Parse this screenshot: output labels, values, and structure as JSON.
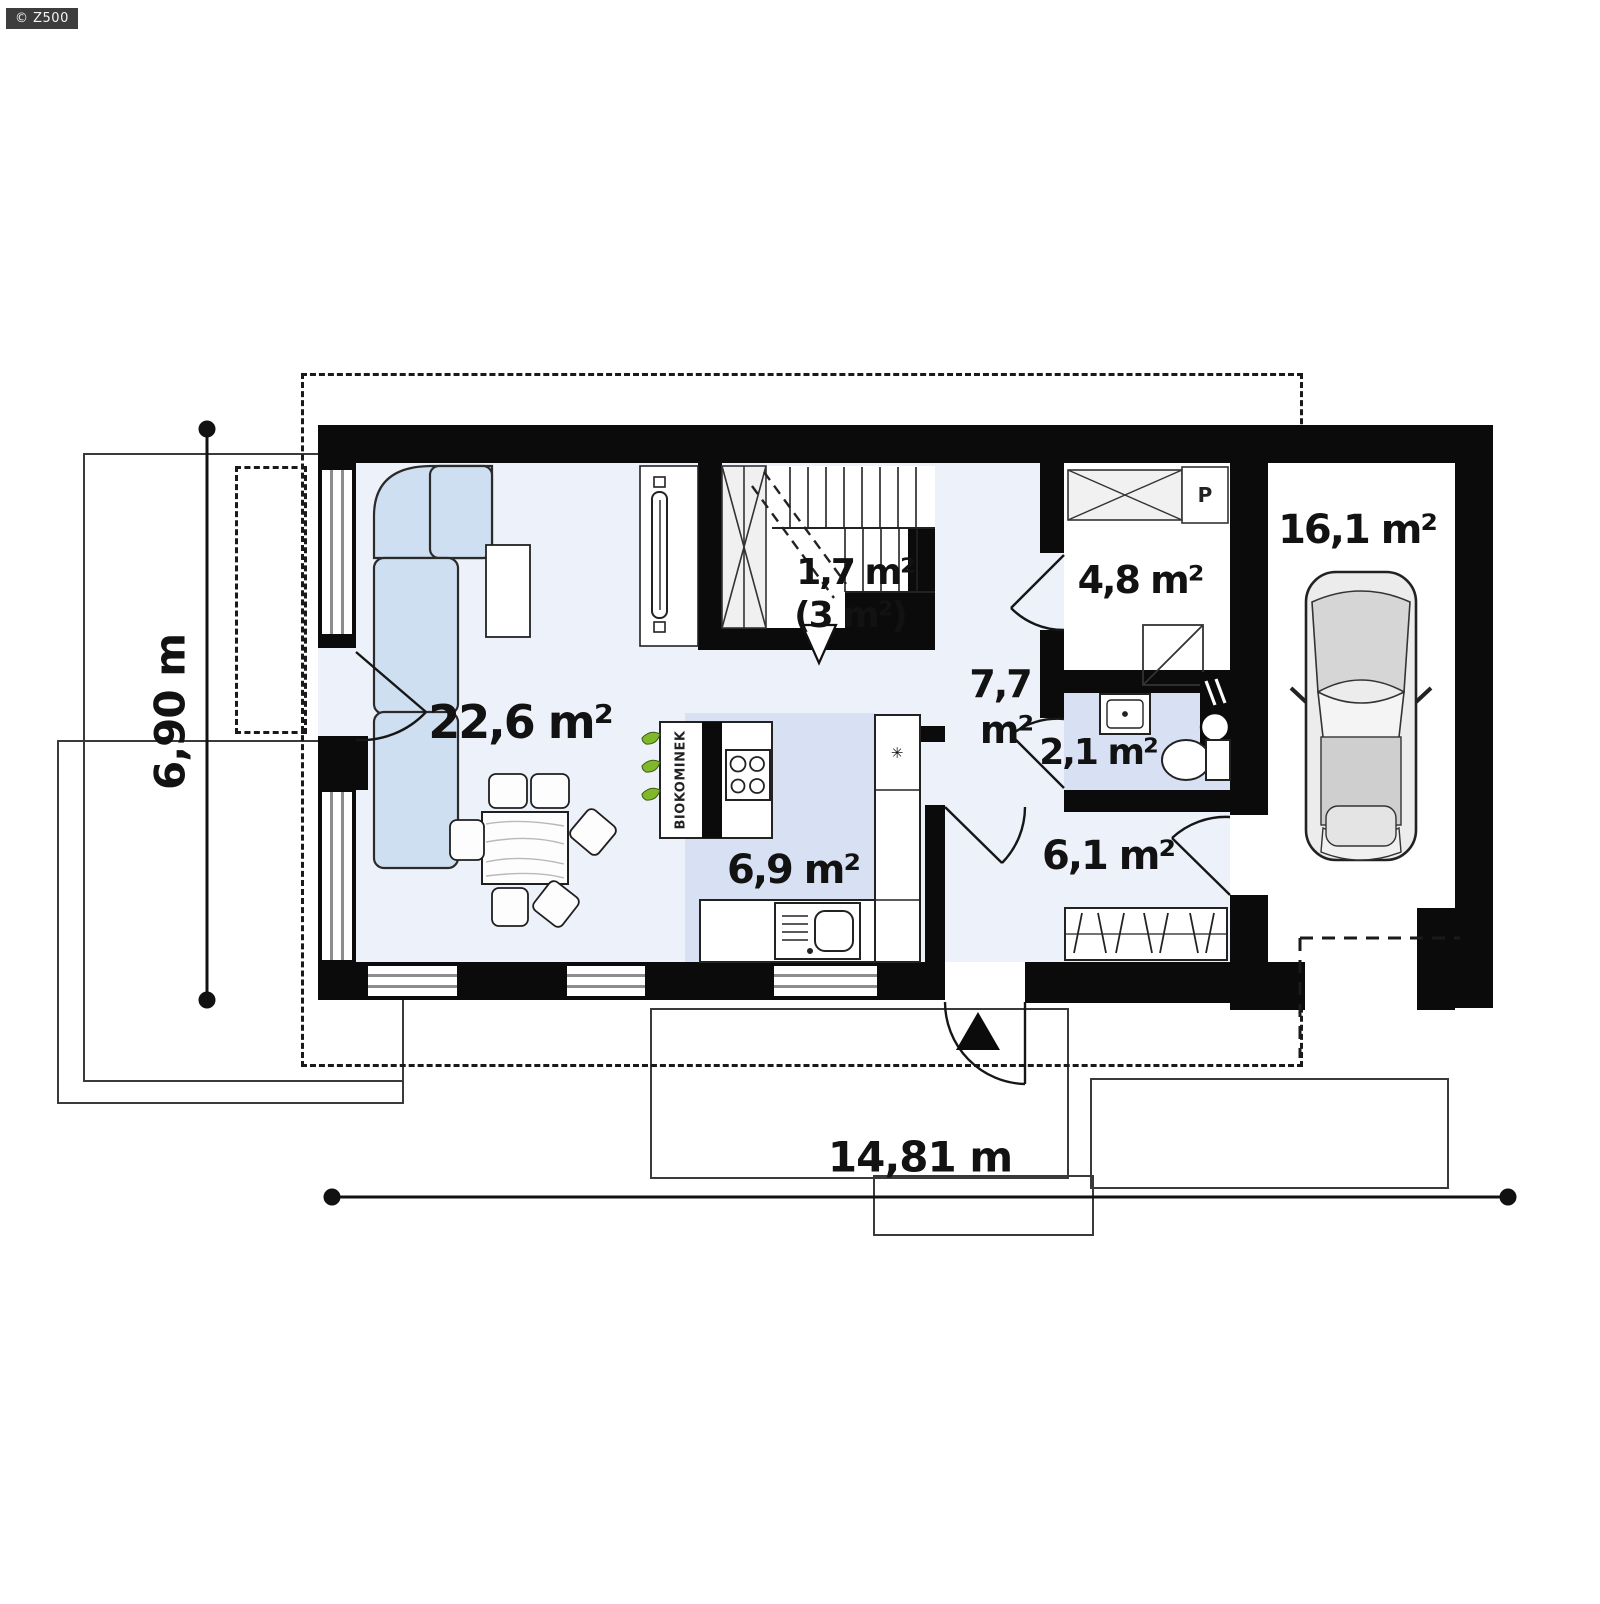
{
  "watermark": "© Z500",
  "rooms": {
    "living": {
      "label": "22,6 m²"
    },
    "stair_storage": {
      "label": "1,7 m²",
      "sub": "(3 m²)"
    },
    "hall": {
      "line1": "7,7",
      "line2": "m²"
    },
    "utility": {
      "label": "4,8 m²"
    },
    "washer": {
      "label": "P"
    },
    "bathroom": {
      "label": "2,1 m²"
    },
    "kitchen": {
      "label": "6,9 m²"
    },
    "entry": {
      "label": "6,1 m²"
    },
    "garage": {
      "label": "16,1 m²"
    }
  },
  "fireplace": {
    "label": "BIOKOMINEK"
  },
  "icons": {
    "fridge_star": "✳"
  },
  "dimensions": {
    "width": "14,81 m",
    "depth": "6,90 m"
  },
  "colors": {
    "wall": "#0b0b0b",
    "floor_light": "#edf1fa",
    "floor_blue": "#d7e1f3",
    "sofa_blue": "#cfdff2",
    "leaf_green": "#7fb82a",
    "car_gray": "#d9d9d9",
    "badge_bg": "#3d3d3d"
  }
}
